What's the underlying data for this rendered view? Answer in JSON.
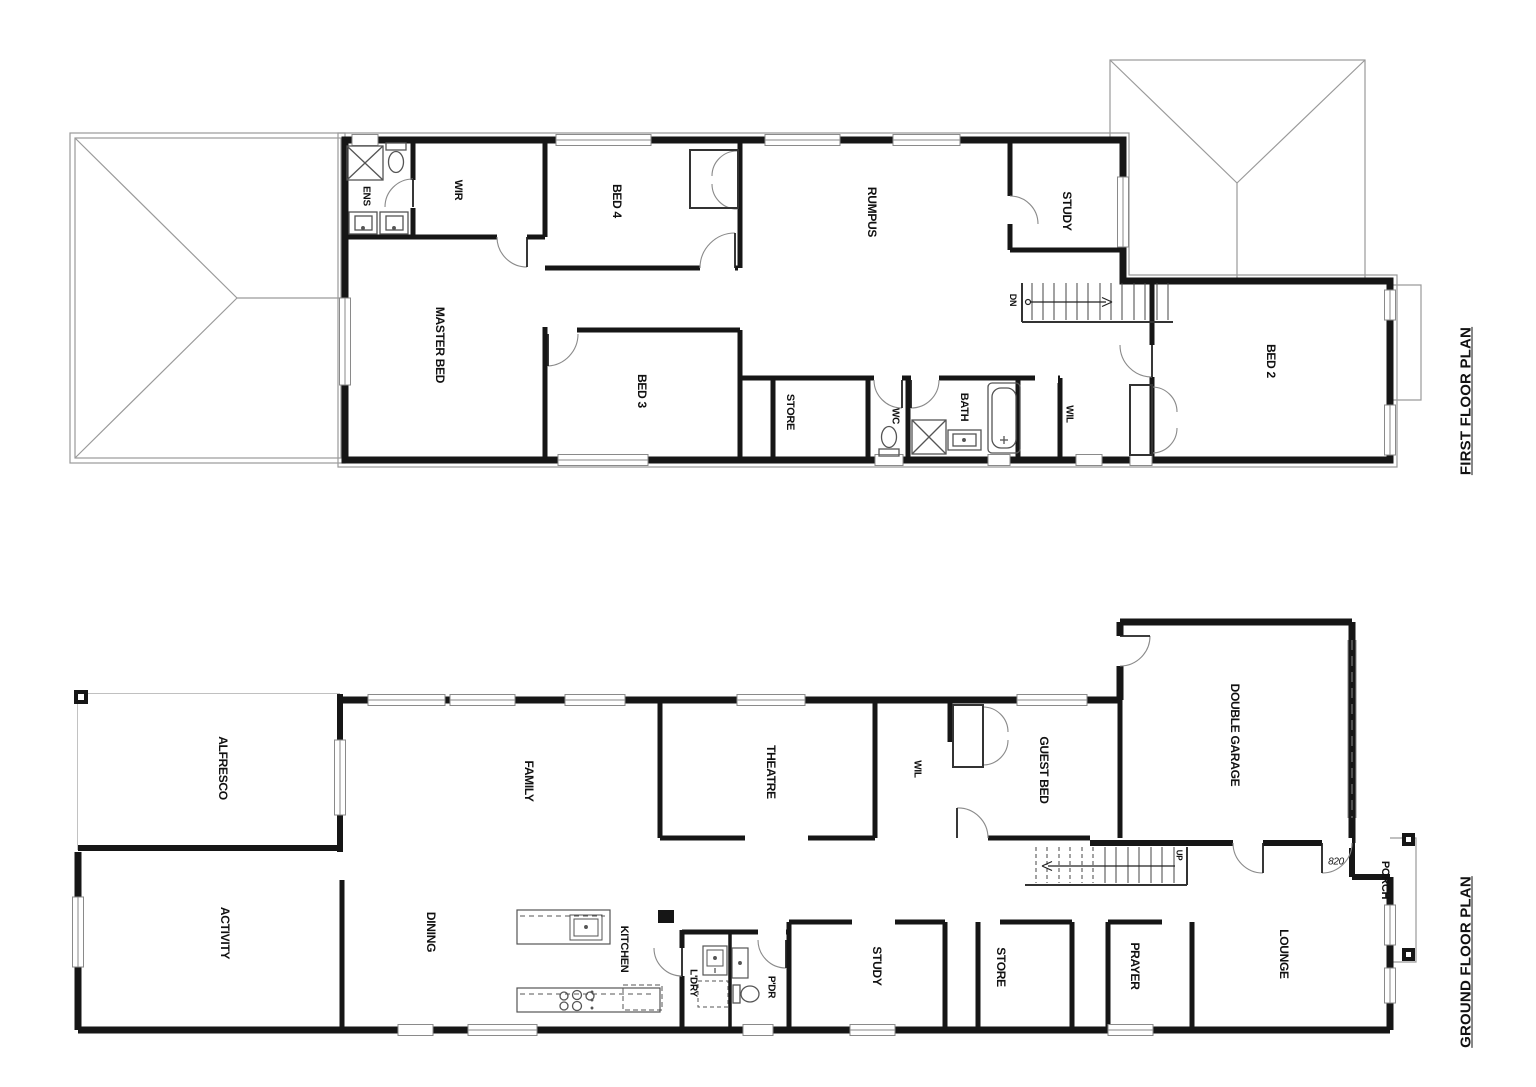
{
  "colors": {
    "wall": "#161616",
    "thin_line": "#9a9a9a",
    "fixture": "#555555",
    "text": "#111111",
    "background": "#ffffff"
  },
  "plans": [
    {
      "id": "first-floor",
      "title": "FIRST FLOOR PLAN",
      "rooms": [
        {
          "label": "ENS",
          "x": 366,
          "y": 196,
          "size": 10
        },
        {
          "label": "WIR",
          "x": 458,
          "y": 190,
          "size": 11
        },
        {
          "label": "BED 4",
          "x": 617,
          "y": 201,
          "size": 12
        },
        {
          "label": "RUMPUS",
          "x": 872,
          "y": 212,
          "size": 12
        },
        {
          "label": "STUDY",
          "x": 1067,
          "y": 211,
          "size": 12
        },
        {
          "label": "MASTER BED",
          "x": 440,
          "y": 345,
          "size": 12
        },
        {
          "label": "BED 3",
          "x": 642,
          "y": 391,
          "size": 12
        },
        {
          "label": "STORE",
          "x": 790,
          "y": 412,
          "size": 11
        },
        {
          "label": "WC",
          "x": 895,
          "y": 416,
          "size": 10
        },
        {
          "label": "BATH",
          "x": 964,
          "y": 407,
          "size": 11
        },
        {
          "label": "WIL",
          "x": 1069,
          "y": 414,
          "size": 10
        },
        {
          "label": "BED 2",
          "x": 1271,
          "y": 361,
          "size": 12
        },
        {
          "label": "DN",
          "x": 1013,
          "y": 300,
          "size": 9
        }
      ]
    },
    {
      "id": "ground-floor",
      "title": "GROUND FLOOR PLAN",
      "rooms": [
        {
          "label": "ALFRESCO",
          "x": 223,
          "y": 768,
          "size": 12
        },
        {
          "label": "ACTIVITY",
          "x": 225,
          "y": 933,
          "size": 12
        },
        {
          "label": "FAMILY",
          "x": 529,
          "y": 781,
          "size": 12
        },
        {
          "label": "DINING",
          "x": 431,
          "y": 932,
          "size": 12
        },
        {
          "label": "KITCHEN",
          "x": 624,
          "y": 949,
          "size": 11
        },
        {
          "label": "L'DRY",
          "x": 693,
          "y": 983,
          "size": 10
        },
        {
          "label": "P'DR",
          "x": 771,
          "y": 987,
          "size": 10
        },
        {
          "label": "THEATRE",
          "x": 771,
          "y": 772,
          "size": 12
        },
        {
          "label": "WIL",
          "x": 917,
          "y": 769,
          "size": 10
        },
        {
          "label": "GUEST BED",
          "x": 1044,
          "y": 770,
          "size": 12
        },
        {
          "label": "DOUBLE GARAGE",
          "x": 1235,
          "y": 735,
          "size": 12
        },
        {
          "label": "STUDY",
          "x": 877,
          "y": 966,
          "size": 12
        },
        {
          "label": "STORE",
          "x": 1001,
          "y": 967,
          "size": 12
        },
        {
          "label": "PRAYER",
          "x": 1135,
          "y": 966,
          "size": 12
        },
        {
          "label": "LOUNGE",
          "x": 1284,
          "y": 954,
          "size": 12
        },
        {
          "label": "PORCH",
          "x": 1385,
          "y": 880,
          "size": 11
        },
        {
          "label": "UP",
          "x": 1179,
          "y": 855,
          "size": 8
        },
        {
          "label": "820",
          "x": 1336,
          "y": 862,
          "size": 10,
          "rot": 0,
          "italic": true
        }
      ]
    }
  ]
}
